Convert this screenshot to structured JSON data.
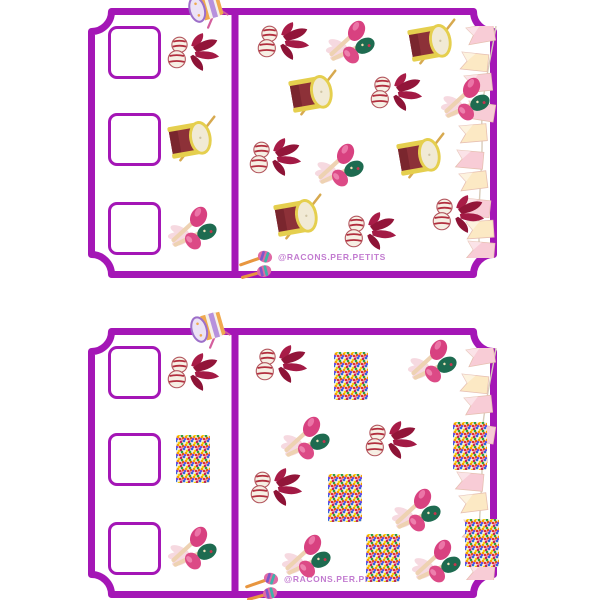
{
  "page": {
    "background": "#ffffff"
  },
  "colors": {
    "ticket_border": "#a416b6",
    "checkbox_border": "#a416b6",
    "watermark_text": "#c27bd0",
    "flag_pink": "#f8ccd6",
    "flag_cream": "#fce9c4",
    "feather_crimson": "#9c1a40",
    "drum_body": "#8d3138",
    "drum_rim": "#e5cf4e",
    "maraca_pink": "#d84180",
    "maraca_green": "#1e6b50"
  },
  "watermark": {
    "handle": "@racons.per.petits"
  },
  "tickets": [
    {
      "name": "ticket-card-1",
      "rows": [
        {
          "icon": "carnival-mask-feathers"
        },
        {
          "icon": "drum"
        },
        {
          "icon": "maracas"
        }
      ],
      "scatter": [
        {
          "icon": "carnival-mask-feathers",
          "x": 195,
          "y": 33
        },
        {
          "icon": "maracas",
          "x": 263,
          "y": 34
        },
        {
          "icon": "drum",
          "x": 345,
          "y": 34
        },
        {
          "icon": "drum",
          "x": 226,
          "y": 85
        },
        {
          "icon": "carnival-mask-feathers",
          "x": 308,
          "y": 84
        },
        {
          "icon": "maracas",
          "x": 378,
          "y": 91
        },
        {
          "icon": "carnival-mask-feathers",
          "x": 187,
          "y": 149
        },
        {
          "icon": "maracas",
          "x": 252,
          "y": 157
        },
        {
          "icon": "drum",
          "x": 334,
          "y": 148
        },
        {
          "icon": "drum",
          "x": 211,
          "y": 209
        },
        {
          "icon": "carnival-mask-feathers",
          "x": 282,
          "y": 223
        },
        {
          "icon": "carnival-mask-feathers",
          "x": 370,
          "y": 206
        }
      ],
      "decorations": [
        {
          "icon": "flag-garland",
          "x": 362,
          "y": 18
        },
        {
          "icon": "toy-drum",
          "x": 95,
          "y": -18
        },
        {
          "icon": "watermark",
          "x": 150,
          "y": 236
        }
      ]
    },
    {
      "name": "ticket-card-2",
      "rows": [
        {
          "icon": "carnival-mask-feathers"
        },
        {
          "icon": "confetti"
        },
        {
          "icon": "maracas"
        }
      ],
      "scatter": [
        {
          "icon": "carnival-mask-feathers",
          "x": 193,
          "y": 36
        },
        {
          "icon": "confetti",
          "x": 263,
          "y": 48
        },
        {
          "icon": "maracas",
          "x": 345,
          "y": 33
        },
        {
          "icon": "maracas",
          "x": 218,
          "y": 110
        },
        {
          "icon": "carnival-mask-feathers",
          "x": 303,
          "y": 112
        },
        {
          "icon": "confetti",
          "x": 382,
          "y": 118
        },
        {
          "icon": "carnival-mask-feathers",
          "x": 188,
          "y": 159
        },
        {
          "icon": "confetti",
          "x": 257,
          "y": 170
        },
        {
          "icon": "maracas",
          "x": 329,
          "y": 182
        },
        {
          "icon": "confetti",
          "x": 394,
          "y": 215
        },
        {
          "icon": "maracas",
          "x": 219,
          "y": 228
        },
        {
          "icon": "confetti",
          "x": 295,
          "y": 230
        },
        {
          "icon": "maracas",
          "x": 349,
          "y": 233
        }
      ],
      "decorations": [
        {
          "icon": "flag-garland",
          "x": 362,
          "y": 20
        },
        {
          "icon": "toy-drum",
          "x": 97,
          "y": -18
        },
        {
          "icon": "watermark",
          "x": 156,
          "y": 238
        }
      ]
    }
  ]
}
